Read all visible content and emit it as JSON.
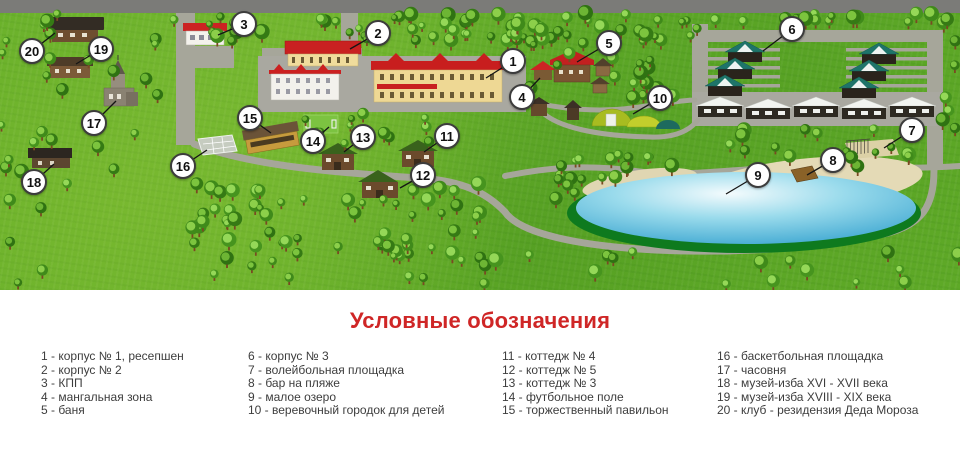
{
  "legend": {
    "title": "Условные обозначения",
    "columns": [
      [
        "1 - корпус № 1, ресепшен",
        "2 - корпус № 2",
        "3 - КПП",
        "4 - мангальная зона",
        "5 - баня"
      ],
      [
        "6 - корпус № 3",
        "7 - волейбольная площадка",
        "8 - бар на пляже",
        "9 - малое озеро",
        "10 - веревочный городок для детей"
      ],
      [
        "11 - коттедж № 4",
        "12 - коттедж № 5",
        "13 - коттедж № 3",
        "14 - футбольное поле",
        "15 - торжественный павильон"
      ],
      [
        "16 - баскетбольная площадка",
        "17 - часовня",
        "18 - музей-изба XVI - XVII века",
        "19 - музей-изба XVIII - XIX века",
        "20 - клуб - резидензия Деда Мороза"
      ]
    ]
  },
  "map": {
    "markers": [
      {
        "n": "1",
        "x": 513,
        "y": 61,
        "lx": 486,
        "ly": 78
      },
      {
        "n": "2",
        "x": 378,
        "y": 33,
        "lx": 350,
        "ly": 49
      },
      {
        "n": "3",
        "x": 244,
        "y": 24,
        "lx": 218,
        "ly": 35
      },
      {
        "n": "4",
        "x": 522,
        "y": 97,
        "lx": 540,
        "ly": 78
      },
      {
        "n": "5",
        "x": 609,
        "y": 43,
        "lx": 577,
        "ly": 62
      },
      {
        "n": "6",
        "x": 792,
        "y": 29,
        "lx": 763,
        "ly": 51
      },
      {
        "n": "7",
        "x": 912,
        "y": 130,
        "lx": 884,
        "ly": 148
      },
      {
        "n": "8",
        "x": 833,
        "y": 160,
        "lx": 807,
        "ly": 175
      },
      {
        "n": "9",
        "x": 758,
        "y": 175,
        "lx": 726,
        "ly": 194
      },
      {
        "n": "10",
        "x": 660,
        "y": 98,
        "lx": 633,
        "ly": 114
      },
      {
        "n": "11",
        "x": 447,
        "y": 136,
        "lx": 424,
        "ly": 152
      },
      {
        "n": "12",
        "x": 423,
        "y": 175,
        "lx": 400,
        "ly": 188
      },
      {
        "n": "13",
        "x": 363,
        "y": 137,
        "lx": 344,
        "ly": 152
      },
      {
        "n": "14",
        "x": 313,
        "y": 141,
        "lx": 329,
        "ly": 127
      },
      {
        "n": "15",
        "x": 250,
        "y": 118,
        "lx": 271,
        "ly": 133
      },
      {
        "n": "16",
        "x": 183,
        "y": 166,
        "lx": 207,
        "ly": 150
      },
      {
        "n": "17",
        "x": 94,
        "y": 123,
        "lx": 116,
        "ly": 101
      },
      {
        "n": "18",
        "x": 34,
        "y": 182,
        "lx": 54,
        "ly": 164
      },
      {
        "n": "19",
        "x": 101,
        "y": 49,
        "lx": 76,
        "ly": 64
      },
      {
        "n": "20",
        "x": 32,
        "y": 51,
        "lx": 55,
        "ly": 33
      }
    ]
  },
  "colors": {
    "title_red": "#cf2626",
    "grass": "#61ac28",
    "road_gray": "#a6a69a",
    "top_road_gray": "#7b7b78",
    "lake_blue": "#41a9d2",
    "lake_rim_green": "#0e7a1e",
    "sand": "#e4dab6",
    "roof_red": "#c82020",
    "cottage_roof_teal": "#1e746a",
    "marker_border": "#3c3c3c"
  }
}
